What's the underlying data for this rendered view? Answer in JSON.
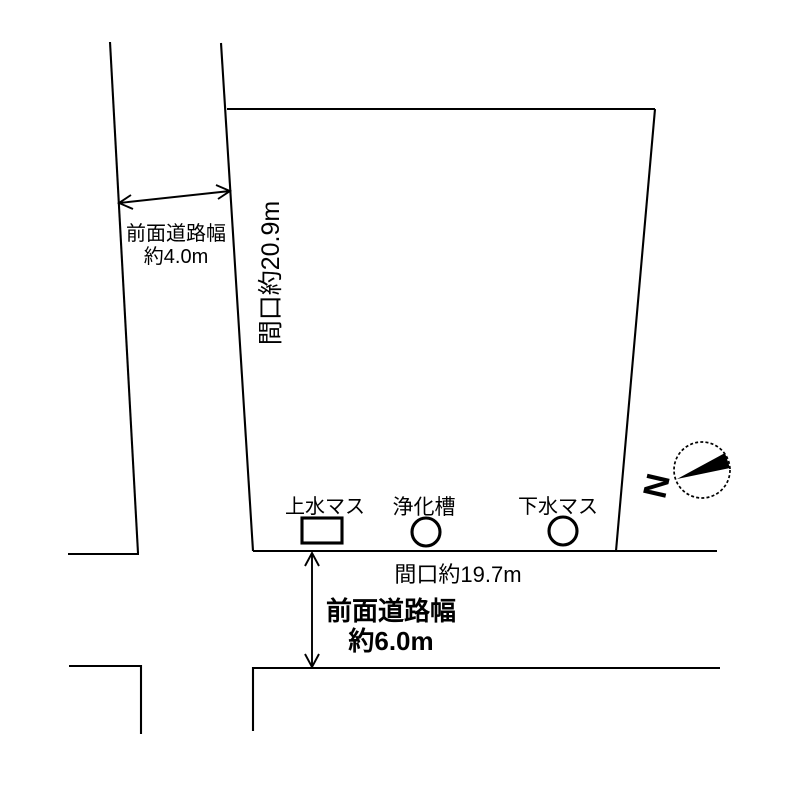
{
  "colors": {
    "line": "#000000",
    "background": "#ffffff",
    "compass_needle": "#000000"
  },
  "left_road": {
    "width_label": "前面道路幅",
    "width_value": "約4.0m",
    "frontage_label": "間口約20.9m"
  },
  "bottom_road": {
    "frontage_label": "間口約19.7m",
    "width_label": "前面道路幅",
    "width_value": "約6.0m"
  },
  "utilities": [
    {
      "id": "water-supply",
      "label": "上水マス",
      "shape": "rect"
    },
    {
      "id": "septic-tank",
      "label": "浄化槽",
      "shape": "circle"
    },
    {
      "id": "sewer",
      "label": "下水マス",
      "shape": "circle"
    }
  ],
  "compass": {
    "north_label": "N"
  }
}
